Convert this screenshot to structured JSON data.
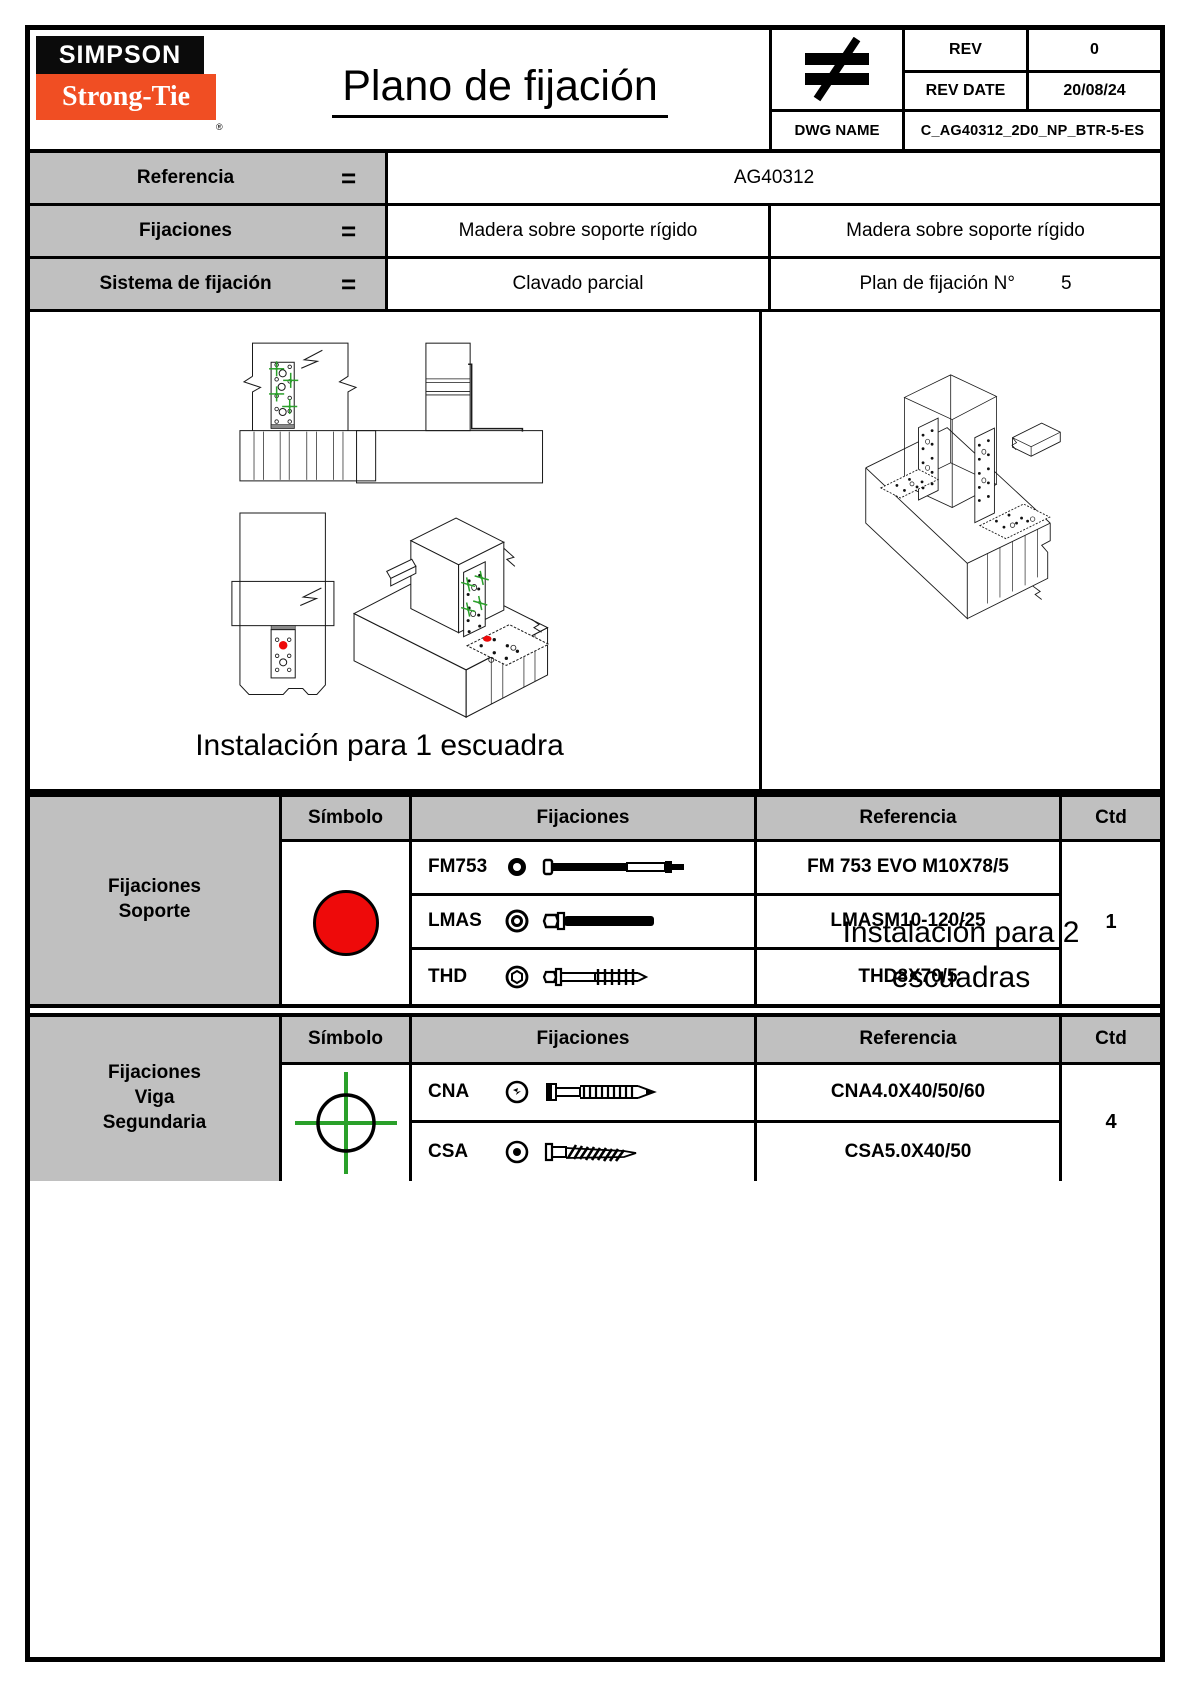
{
  "header": {
    "logo_line1": "SIMPSON",
    "logo_line2": "Strong-Tie",
    "logo_reg": "®",
    "title": "Plano de fijación",
    "projection_symbol": "≠",
    "rev": {
      "label": "REV",
      "value": "0"
    },
    "rev_date": {
      "label": "REV DATE",
      "value": "20/08/24"
    },
    "dwg": {
      "label": "DWG NAME",
      "value": "C_AG40312_2D0_NP_BTR-5-ES"
    }
  },
  "info": {
    "rows": [
      {
        "label": "Referencia",
        "eq": "=",
        "value": "AG40312"
      },
      {
        "label": "Fijaciones",
        "eq": "=",
        "left": "Madera sobre soporte rígido",
        "right": "Madera sobre soporte rígido"
      },
      {
        "label": "Sistema de fijación",
        "eq": "=",
        "left": "Clavado parcial",
        "right_label": "Plan de fijación N°",
        "right_value": "5"
      }
    ]
  },
  "drawing": {
    "caption_one": "Instalación para 1 escuadra",
    "caption_two_line1": "Instalación para 2",
    "caption_two_line2": "escuadras"
  },
  "tables": [
    {
      "group_lines": [
        "Fijaciones",
        "Soporte"
      ],
      "col_symbol": "Símbolo",
      "col_fixings": "Fijaciones",
      "col_reference": "Referencia",
      "col_qty": "Ctd",
      "symbol": "red-circle",
      "rows": [
        {
          "code": "FM753",
          "reference": "FM 753 EVO M10X78/5"
        },
        {
          "code": "LMAS",
          "reference": "LMASM10-120/25"
        },
        {
          "code": "THD",
          "reference": "THD8X70/5"
        }
      ],
      "qty": "1"
    },
    {
      "group_lines": [
        "Fijaciones",
        "Viga",
        "Segundaria"
      ],
      "col_symbol": "Símbolo",
      "col_fixings": "Fijaciones",
      "col_reference": "Referencia",
      "col_qty": "Ctd",
      "symbol": "green-crosshair",
      "rows": [
        {
          "code": "CNA",
          "reference": "CNA4.0X40/50/60"
        },
        {
          "code": "CSA",
          "reference": "CSA5.0X40/50"
        }
      ],
      "qty": "4"
    }
  ],
  "colors": {
    "brand_orange": "#f04e23",
    "symbol_red": "#ee0a0a",
    "marker_green": "#2aa02a",
    "header_gray": "#c0c0c0"
  }
}
